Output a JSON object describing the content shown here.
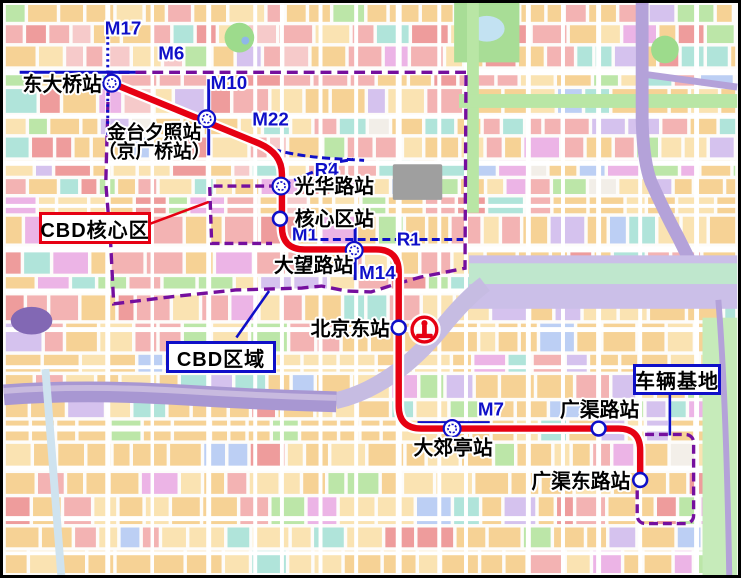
{
  "map": {
    "colors": {
      "main_line_red": "#e60012",
      "transit_blue": "#0f0fc8",
      "boundary_purple": "#750f9e",
      "station_fill": "#ffffff",
      "label_text": "#000000",
      "label_halo": "#ffffff"
    },
    "stations": [
      {
        "name": "东大桥站",
        "type": "transfer",
        "x": 109,
        "y": 81,
        "label": {
          "x": 99,
          "y": 89,
          "anchor": "end"
        }
      },
      {
        "name": "金台夕照站",
        "name2": "（京广桥站）",
        "type": "transfer",
        "x": 205,
        "y": 117,
        "label": {
          "x": 152,
          "y": 137,
          "anchor": "middle",
          "y2": 156
        }
      },
      {
        "name": "光华路站",
        "type": "transfer",
        "x": 280,
        "y": 185,
        "label": {
          "x": 294,
          "y": 192,
          "anchor": "start"
        }
      },
      {
        "name": "核心区站",
        "type": "regular",
        "x": 279,
        "y": 218,
        "label": {
          "x": 294,
          "y": 225,
          "anchor": "start"
        }
      },
      {
        "name": "大望路站",
        "type": "transfer",
        "x": 354,
        "y": 250,
        "label": {
          "x": 273,
          "y": 272,
          "anchor": "start"
        }
      },
      {
        "name": "北京东站",
        "type": "regular",
        "x": 399,
        "y": 328,
        "label": {
          "x": 390,
          "y": 336,
          "anchor": "end"
        }
      },
      {
        "name": "大郊亭站",
        "type": "transfer",
        "x": 453,
        "y": 430,
        "label": {
          "x": 454,
          "y": 456,
          "anchor": "middle"
        }
      },
      {
        "name": "广渠路站",
        "type": "regular",
        "x": 601,
        "y": 430,
        "label": {
          "x": 562,
          "y": 418,
          "anchor": "start"
        }
      },
      {
        "name": "广渠东路站",
        "type": "regular",
        "x": 643,
        "y": 482,
        "label": {
          "x": 633,
          "y": 490,
          "anchor": "end"
        }
      }
    ],
    "other_lines": [
      {
        "name": "M17",
        "style": "dotted",
        "path": "M105,34 L105,140",
        "label": {
          "x": 102,
          "y": 32,
          "anchor": "start"
        }
      },
      {
        "name": "M6",
        "style": "solid",
        "path": "M16,70 L133,70",
        "label": {
          "x": 156,
          "y": 57,
          "anchor": "start"
        }
      },
      {
        "name": "M10",
        "style": "solid",
        "path": "M207,77 L207,154",
        "label": {
          "x": 209,
          "y": 87,
          "anchor": "start"
        }
      },
      {
        "name": "M22",
        "style": "dashed",
        "path": "M110,83 L258,143 Q286,154 330,157 L364,159",
        "label": {
          "x": 251,
          "y": 124,
          "anchor": "start"
        }
      },
      {
        "name": "R4",
        "style": "dashed",
        "path": "M282,184 L335,161 L353,158",
        "label": {
          "x": 314,
          "y": 175,
          "anchor": "start"
        }
      },
      {
        "name": "M1",
        "style": "none",
        "path": "",
        "label": {
          "x": 291,
          "y": 240,
          "anchor": "start"
        }
      },
      {
        "name": "R1",
        "style": "dashed",
        "path": "M320,239 L464,239",
        "label": {
          "x": 397,
          "y": 245,
          "anchor": "start"
        }
      },
      {
        "name": "M14",
        "style": "solid",
        "path": "M355,224 L355,280",
        "label": {
          "x": 359,
          "y": 279,
          "anchor": "start"
        }
      },
      {
        "name": "M7",
        "style": "solid",
        "path": "M418,424 L491,424",
        "label": {
          "x": 479,
          "y": 417,
          "anchor": "start"
        }
      }
    ],
    "annotations": [
      {
        "label": "CBD核心区",
        "border_color": "#e60012"
      },
      {
        "label": "CBD区域",
        "border_color": "#0f0fc8"
      },
      {
        "label": "车辆基地",
        "border_color": "#0f0fc8"
      }
    ]
  }
}
